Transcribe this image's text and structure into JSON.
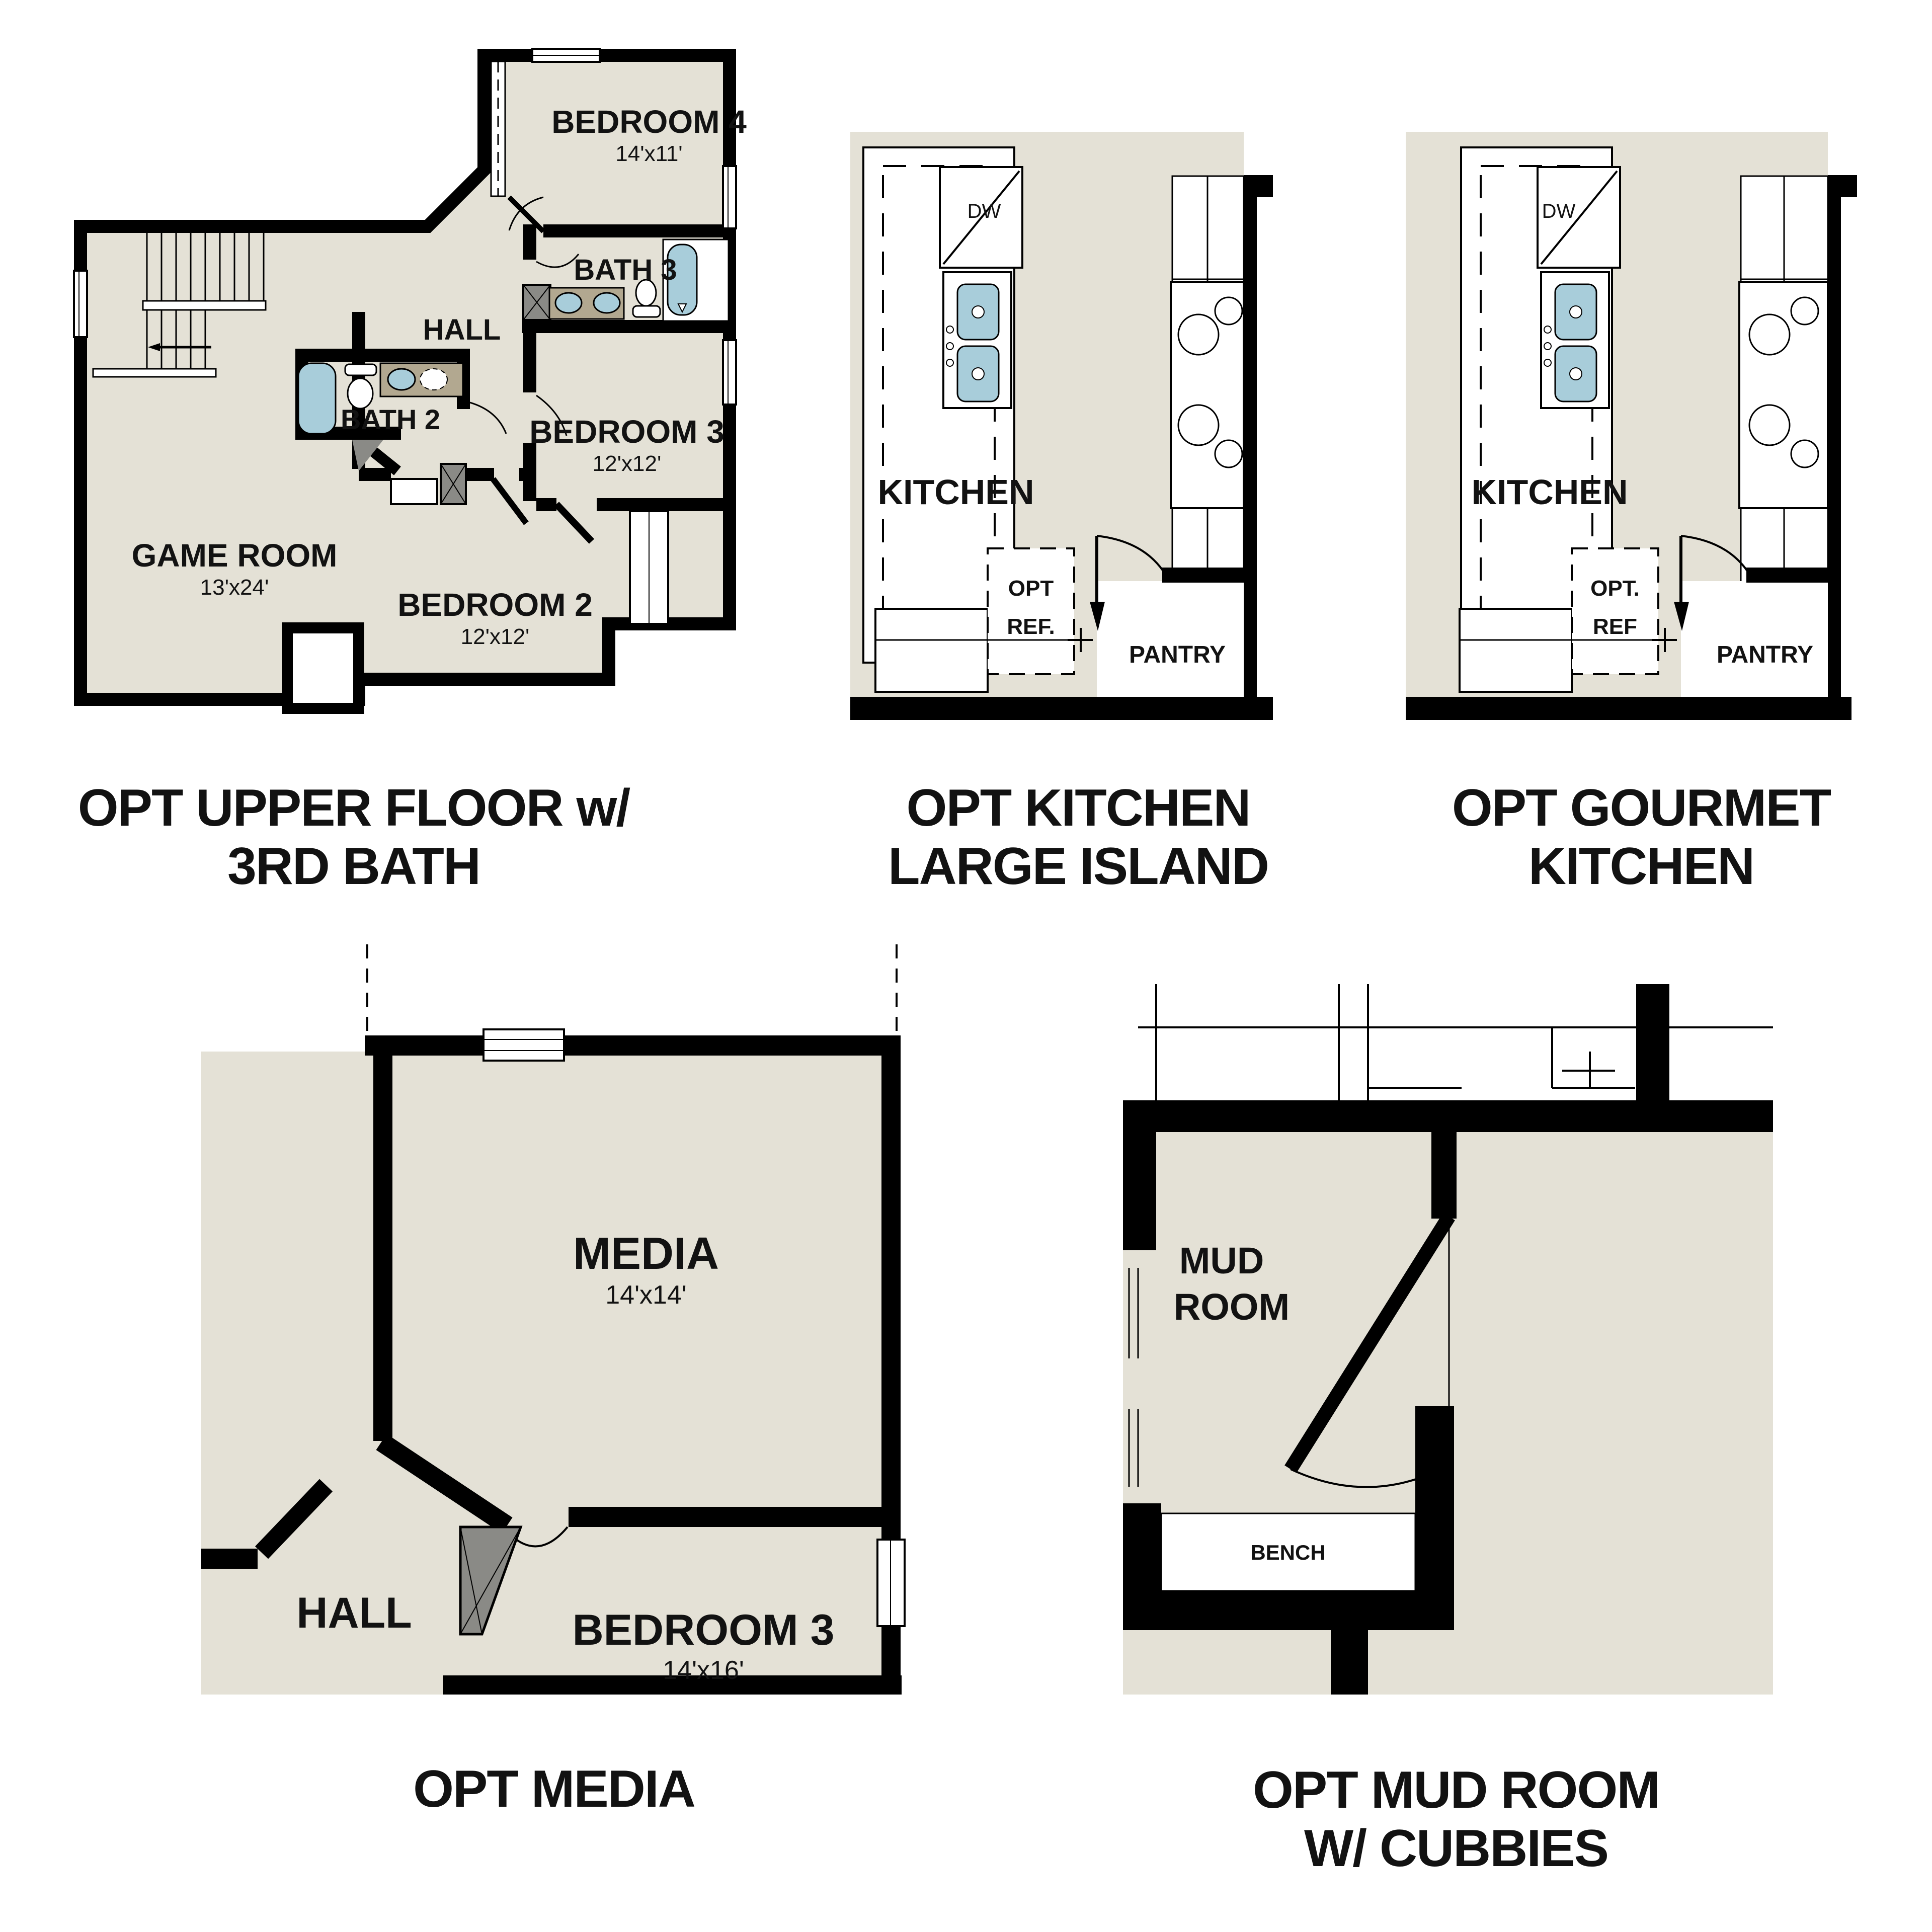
{
  "sheet_title": "Floor plan options sheet",
  "colors": {
    "floor": "#e4e1d6",
    "wall": "#000000",
    "fixture_blue": "#a8cdda",
    "counter_tan": "#b2a890",
    "closet_gray": "#8a8a86"
  },
  "plans": {
    "upper_floor": {
      "caption": [
        "OPT UPPER FLOOR w/",
        "3RD BATH"
      ],
      "rooms": {
        "bedroom4": {
          "name": "BEDROOM 4",
          "dims": "14'x11'"
        },
        "bath3": {
          "name": "BATH 3"
        },
        "hall": {
          "name": "HALL"
        },
        "bath2": {
          "name": "BATH 2"
        },
        "bedroom3": {
          "name": "BEDROOM 3",
          "dims": "12'x12'"
        },
        "game_room": {
          "name": "GAME ROOM",
          "dims": "13'x24'"
        },
        "bedroom2": {
          "name": "BEDROOM 2",
          "dims": "12'x12'"
        }
      }
    },
    "kitchen_island": {
      "caption": [
        "OPT KITCHEN",
        "LARGE ISLAND"
      ],
      "labels": {
        "kitchen": "KITCHEN",
        "dw": "DW",
        "ref": [
          "OPT",
          "REF."
        ],
        "pantry": "PANTRY"
      }
    },
    "gourmet_kitchen": {
      "caption": [
        "OPT GOURMET",
        "KITCHEN"
      ],
      "labels": {
        "kitchen": "KITCHEN",
        "dw": "DW",
        "ref": [
          "OPT.",
          "REF"
        ],
        "pantry": "PANTRY"
      }
    },
    "media": {
      "caption": [
        "OPT MEDIA"
      ],
      "rooms": {
        "media": {
          "name": "MEDIA",
          "dims": "14'x14'"
        },
        "hall": {
          "name": "HALL"
        },
        "bedroom3": {
          "name": "BEDROOM 3",
          "dims": "14'x16'"
        }
      }
    },
    "mud_room": {
      "caption": [
        "OPT MUD ROOM",
        "W/ CUBBIES"
      ],
      "labels": {
        "room": [
          "MUD",
          "ROOM"
        ],
        "bench": "BENCH"
      }
    }
  }
}
